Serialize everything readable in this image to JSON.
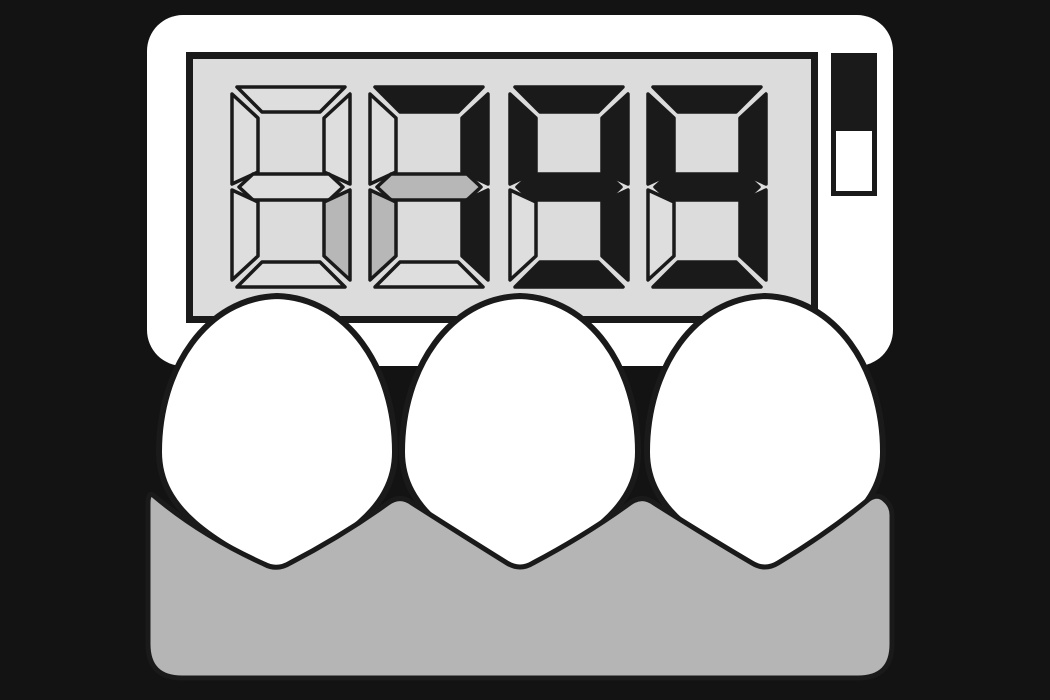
{
  "scene": {
    "title": "Digital egg timer resting on an egg carton with three eggs",
    "background_color": "#131313"
  },
  "timer": {
    "body_color": "#ffffff",
    "display": {
      "background_color": "#dcdcdc",
      "border_color": "#1a1a1a",
      "segment_on_color": "#1a1a1a",
      "segment_half_color": "#b7b7b7",
      "segment_off_color": "#dedede",
      "digit_count": 4,
      "digits": [
        {
          "a": "off",
          "b": "off",
          "c": "half",
          "d": "off",
          "e": "off",
          "f": "off",
          "g": "off"
        },
        {
          "a": "on",
          "b": "on",
          "c": "on",
          "d": "off",
          "e": "half",
          "f": "off",
          "g": "half"
        },
        {
          "a": "on",
          "b": "on",
          "c": "on",
          "d": "on",
          "e": "off",
          "f": "on",
          "g": "on"
        },
        {
          "a": "on",
          "b": "on",
          "c": "on",
          "d": "on",
          "e": "off",
          "f": "on",
          "g": "on"
        }
      ]
    },
    "indicator": {
      "top_fill_color": "#1a1a1a",
      "bottom_fill_color": "#ffffff",
      "outline_color": "#1a1a1a"
    }
  },
  "eggs": {
    "count": 3,
    "fill_color": "#ffffff",
    "outline_color": "#1a1a1a"
  },
  "carton": {
    "fill_color": "#b5b5b5",
    "outline_color": "#1a1a1a"
  }
}
